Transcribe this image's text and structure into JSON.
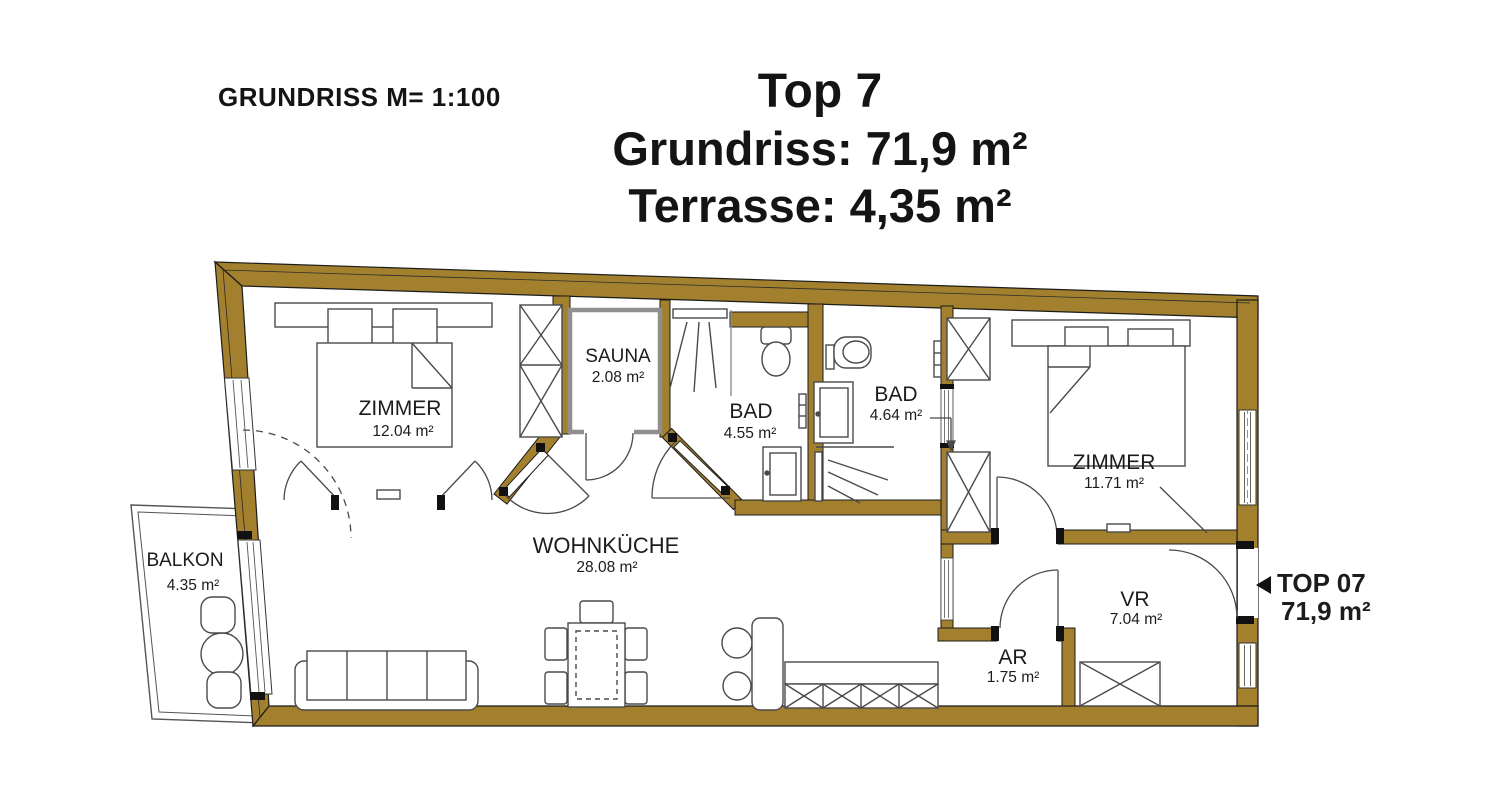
{
  "header": {
    "scale": "GRUNDRISS M= 1:100"
  },
  "title": {
    "unit": "Top 7",
    "floor_area": "Grundriss: 71,9 m²",
    "terrace_area": "Terrasse: 4,35 m²"
  },
  "unit_marker": {
    "label": "TOP 07",
    "area": "71,9 m²"
  },
  "rooms": {
    "bedroom1": {
      "name": "ZIMMER",
      "area": "12.04 m²"
    },
    "sauna": {
      "name": "SAUNA",
      "area": "2.08 m²"
    },
    "bath1": {
      "name": "BAD",
      "area": "4.55 m²"
    },
    "bath2": {
      "name": "BAD",
      "area": "4.64 m²"
    },
    "bedroom2": {
      "name": "ZIMMER",
      "area": "11.71 m²"
    },
    "living_kitchen": {
      "name": "WOHNKÜCHE",
      "area": "28.08 m²"
    },
    "hall": {
      "name": "VR",
      "area": "7.04 m²"
    },
    "storage": {
      "name": "AR",
      "area": "1.75 m²"
    },
    "balcony": {
      "name": "BALKON",
      "area": "4.35 m²"
    }
  },
  "colors": {
    "wall": "#A3802D",
    "outline": "#1B1B1B",
    "furniture": "#4A4A4A",
    "sauna_wall": "#8F8F8F",
    "background": "#FFFFFF"
  }
}
